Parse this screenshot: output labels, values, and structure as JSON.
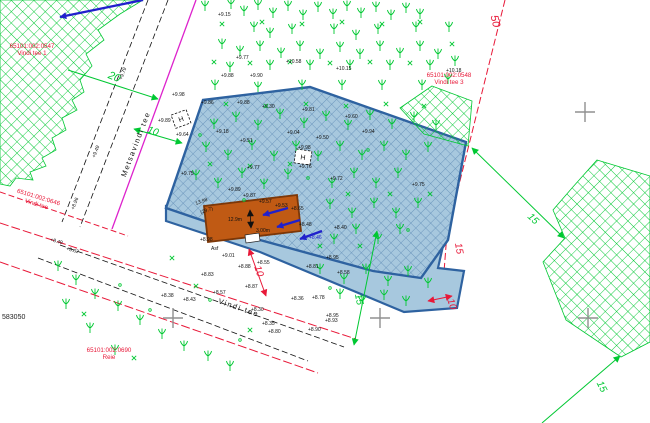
{
  "canvas": {
    "w": 650,
    "h": 423,
    "bg": "#ffffff"
  },
  "palette": {
    "cad_green": "#00c832",
    "cad_red": "#e81838",
    "magenta": "#dd22cc",
    "blue_arrow": "#2020cc",
    "parcel_fill": "#a7c8de",
    "parcel_hatch": "#5d89b4",
    "parcel_border": "#2e62a0",
    "building_fill": "#c05a14",
    "building_border": "#7c3708",
    "grid_gray": "#909090",
    "text_black": "#111111"
  },
  "areas": {
    "forest_nw": {
      "points": [
        [
          0,
          0
        ],
        [
          143,
          0
        ],
        [
          120,
          14
        ],
        [
          98,
          30
        ],
        [
          104,
          40
        ],
        [
          86,
          54
        ],
        [
          92,
          66
        ],
        [
          80,
          80
        ],
        [
          84,
          92
        ],
        [
          72,
          100
        ],
        [
          77,
          110
        ],
        [
          62,
          118
        ],
        [
          66,
          130
        ],
        [
          52,
          138
        ],
        [
          56,
          150
        ],
        [
          42,
          158
        ],
        [
          46,
          166
        ],
        [
          30,
          172
        ],
        [
          33,
          180
        ],
        [
          16,
          178
        ],
        [
          10,
          186
        ],
        [
          0,
          184
        ]
      ]
    },
    "forest_ne": {
      "points": [
        [
          432,
          86
        ],
        [
          472,
          101
        ],
        [
          468,
          146
        ],
        [
          424,
          134
        ],
        [
          400,
          108
        ]
      ]
    },
    "forest_se": {
      "points": [
        [
          597,
          160
        ],
        [
          650,
          176
        ],
        [
          650,
          342
        ],
        [
          621,
          357
        ],
        [
          566,
          320
        ],
        [
          543,
          262
        ],
        [
          565,
          238
        ],
        [
          553,
          210
        ],
        [
          572,
          188
        ]
      ]
    },
    "parcel_strip": {
      "points": [
        [
          166,
          206
        ],
        [
          445,
          237
        ],
        [
          438,
          268
        ],
        [
          464,
          271
        ],
        [
          457,
          308
        ],
        [
          404,
          312
        ],
        [
          260,
          252
        ],
        [
          166,
          221
        ]
      ]
    },
    "parcel_main": {
      "points": [
        [
          203,
          100
        ],
        [
          310,
          87
        ],
        [
          466,
          142
        ],
        [
          448,
          240
        ],
        [
          421,
          278
        ],
        [
          373,
          271
        ],
        [
          260,
          240
        ],
        [
          166,
          208
        ]
      ]
    }
  },
  "building": {
    "outline": [
      [
        204,
        206
      ],
      [
        297,
        195
      ],
      [
        301,
        231
      ],
      [
        208,
        242
      ]
    ],
    "annex": [
      [
        245,
        235
      ],
      [
        259,
        233
      ],
      [
        260,
        241
      ],
      [
        246,
        243
      ]
    ],
    "door_line": [
      250,
      210,
      251,
      228
    ],
    "labels": [
      {
        "t": "12.9m",
        "x": 228,
        "y": 221
      },
      {
        "t": "3.00m",
        "x": 256,
        "y": 232
      }
    ]
  },
  "road_lines": [
    {
      "x1": 196,
      "y1": 0,
      "x2": 112,
      "y2": 229,
      "c": "magenta",
      "w": 1.3,
      "d": ""
    },
    {
      "x1": 168,
      "y1": 0,
      "x2": 80,
      "y2": 227,
      "c": "black",
      "w": 0.8,
      "d": "6,3"
    },
    {
      "x1": 148,
      "y1": 0,
      "x2": 62,
      "y2": 222,
      "c": "black",
      "w": 0.8,
      "d": "6,3"
    },
    {
      "x1": 0,
      "y1": 223,
      "x2": 356,
      "y2": 339,
      "c": "red",
      "w": 1,
      "d": "9,3"
    },
    {
      "x1": 60,
      "y1": 245,
      "x2": 344,
      "y2": 347,
      "c": "black",
      "w": 0.8,
      "d": "6,3"
    },
    {
      "x1": 38,
      "y1": 258,
      "x2": 308,
      "y2": 361,
      "c": "black",
      "w": 0.8,
      "d": "6,3"
    },
    {
      "x1": 0,
      "y1": 262,
      "x2": 318,
      "y2": 373,
      "c": "red",
      "w": 1,
      "d": "9,3"
    },
    {
      "x1": 0,
      "y1": 192,
      "x2": 128,
      "y2": 236,
      "c": "red",
      "w": 1,
      "d": "6,3"
    },
    {
      "x1": 505,
      "y1": 0,
      "x2": 447,
      "y2": 233,
      "c": "red",
      "w": 1,
      "d": "7,3"
    },
    {
      "x1": 447,
      "y1": 233,
      "x2": 442,
      "y2": 298,
      "c": "red",
      "w": 1,
      "d": "7,3"
    }
  ],
  "road_names": [
    {
      "t": "Metsavindi tee",
      "x": 138,
      "y": 145,
      "r": -69
    },
    {
      "t": "Vindi tee",
      "x": 238,
      "y": 310,
      "r": 19
    }
  ],
  "dimensions": [
    {
      "t": "20",
      "x": 113,
      "y": 80,
      "r": 22,
      "c": "green",
      "s": 11,
      "line": [
        68,
        70,
        158,
        99
      ],
      "heads": "end"
    },
    {
      "t": "10",
      "x": 152,
      "y": 134,
      "r": 20,
      "c": "green",
      "s": 10,
      "line": [
        134,
        129,
        182,
        143
      ],
      "heads": "both"
    },
    {
      "t": "50",
      "x": 492,
      "y": 22,
      "r": 76,
      "c": "red",
      "s": 11
    },
    {
      "t": "15",
      "x": 456,
      "y": 249,
      "r": 80,
      "c": "red",
      "s": 10
    },
    {
      "t": "10",
      "x": 449,
      "y": 305,
      "r": 72,
      "c": "red",
      "s": 10,
      "line": [
        428,
        301,
        452,
        296
      ],
      "heads": "both"
    },
    {
      "t": "10",
      "x": 256,
      "y": 272,
      "r": 72,
      "c": "red",
      "s": 10,
      "line": [
        249,
        249,
        266,
        296
      ],
      "heads": "both"
    },
    {
      "t": "15",
      "x": 356,
      "y": 300,
      "r": 78,
      "c": "green",
      "s": 10,
      "line": [
        377,
        231,
        354,
        345
      ],
      "heads": "both"
    },
    {
      "t": "15",
      "x": 531,
      "y": 221,
      "r": 44,
      "c": "green",
      "s": 10,
      "line": [
        472,
        148,
        564,
        238
      ],
      "heads": "both"
    },
    {
      "t": "15",
      "x": 599,
      "y": 388,
      "r": 63,
      "c": "green",
      "s": 10,
      "line": [
        620,
        356,
        542,
        423
      ],
      "heads": "start"
    }
  ],
  "cadastral": [
    {
      "lines": [
        "65101:002:0547",
        "Vindi tee 1"
      ],
      "x": 32,
      "y": 48,
      "r": 0
    },
    {
      "lines": [
        "65101:002:0548",
        "Vindi tee 3"
      ],
      "x": 449,
      "y": 77,
      "r": 0
    },
    {
      "lines": [
        "65101:002:0690",
        "Reie"
      ],
      "x": 109,
      "y": 352,
      "r": 0
    },
    {
      "lines": [
        "65101:002:0646",
        "Vindi tee"
      ],
      "x": 38,
      "y": 199,
      "r": 17
    }
  ],
  "grid": {
    "coord_label": {
      "t": "583050",
      "x": 2,
      "y": 319
    },
    "crosses": [
      [
        173,
        318
      ],
      [
        380,
        318
      ],
      [
        588,
        318
      ],
      [
        585,
        112
      ]
    ]
  },
  "elevations": [
    {
      "t": "+9.15",
      "x": 218,
      "y": 16
    },
    {
      "t": "+9.77",
      "x": 236,
      "y": 59
    },
    {
      "t": "+10.58",
      "x": 286,
      "y": 63
    },
    {
      "t": "+9.88",
      "x": 221,
      "y": 77
    },
    {
      "t": "+9.90",
      "x": 250,
      "y": 77
    },
    {
      "t": "+10.15",
      "x": 336,
      "y": 70
    },
    {
      "t": "+10.18",
      "x": 446,
      "y": 72
    },
    {
      "t": "+9.98",
      "x": 172,
      "y": 96
    },
    {
      "t": "+9.89",
      "x": 158,
      "y": 122
    },
    {
      "t": "+9.86",
      "x": 201,
      "y": 104
    },
    {
      "t": "+9.88",
      "x": 237,
      "y": 104
    },
    {
      "t": "+9.30",
      "x": 262,
      "y": 108
    },
    {
      "t": "+9.81",
      "x": 302,
      "y": 111
    },
    {
      "t": "+9.64",
      "x": 176,
      "y": 136
    },
    {
      "t": "+9.18",
      "x": 216,
      "y": 133
    },
    {
      "t": "+9.04",
      "x": 287,
      "y": 134
    },
    {
      "t": "+9.50",
      "x": 316,
      "y": 139
    },
    {
      "t": "+9.51",
      "x": 240,
      "y": 142
    },
    {
      "t": "+9.98",
      "x": 298,
      "y": 149
    },
    {
      "t": "+9.60",
      "x": 345,
      "y": 118
    },
    {
      "t": "+9.94",
      "x": 362,
      "y": 133
    },
    {
      "t": "+9.77",
      "x": 247,
      "y": 169
    },
    {
      "t": "+9.76",
      "x": 299,
      "y": 168
    },
    {
      "t": "+9.75",
      "x": 181,
      "y": 175
    },
    {
      "t": "+9.72",
      "x": 330,
      "y": 180
    },
    {
      "t": "+9.75",
      "x": 412,
      "y": 186
    },
    {
      "t": "+9.89",
      "x": 228,
      "y": 191
    },
    {
      "t": "+9.87",
      "x": 243,
      "y": 197
    },
    {
      "t": "+9.57",
      "x": 259,
      "y": 203
    },
    {
      "t": "+9.53",
      "x": 275,
      "y": 207
    },
    {
      "t": "+8.65",
      "x": 291,
      "y": 210
    },
    {
      "t": "+8.48",
      "x": 299,
      "y": 226
    },
    {
      "t": "13.98",
      "x": 196,
      "y": 205,
      "r": -20
    },
    {
      "t": "(29.7)",
      "x": 201,
      "y": 214,
      "r": -20
    },
    {
      "t": "+8.55",
      "x": 257,
      "y": 264
    },
    {
      "t": "+8.40",
      "x": 334,
      "y": 229
    },
    {
      "t": "+8.46",
      "x": 309,
      "y": 239,
      "c": "#2020cc"
    },
    {
      "t": "+8.95",
      "x": 326,
      "y": 259
    },
    {
      "t": "+8.81",
      "x": 306,
      "y": 268
    },
    {
      "t": "+8.58",
      "x": 337,
      "y": 274
    },
    {
      "t": "+8.78",
      "x": 312,
      "y": 299
    },
    {
      "t": "+8.95",
      "x": 326,
      "y": 317
    },
    {
      "t": "Asf",
      "x": 211,
      "y": 250
    },
    {
      "t": "+9.01",
      "x": 222,
      "y": 257
    },
    {
      "t": "+8.98",
      "x": 200,
      "y": 241
    },
    {
      "t": "+8.88",
      "x": 238,
      "y": 268
    },
    {
      "t": "+8.83",
      "x": 201,
      "y": 276
    },
    {
      "t": "+8.87",
      "x": 245,
      "y": 288
    },
    {
      "t": "+8.57",
      "x": 213,
      "y": 294
    },
    {
      "t": "+8.43",
      "x": 183,
      "y": 301
    },
    {
      "t": "+8.38",
      "x": 161,
      "y": 297
    },
    {
      "t": "+8.36",
      "x": 291,
      "y": 300
    },
    {
      "t": "+8.30",
      "x": 251,
      "y": 311
    },
    {
      "t": "+8.93",
      "x": 325,
      "y": 322
    },
    {
      "t": "+8.90",
      "x": 308,
      "y": 331
    },
    {
      "t": "+8.80",
      "x": 268,
      "y": 333
    },
    {
      "t": "+8.35",
      "x": 262,
      "y": 325
    },
    {
      "t": "+8.49",
      "x": 50,
      "y": 241,
      "r": 15
    },
    {
      "t": "+8.62",
      "x": 66,
      "y": 250,
      "r": 15
    },
    {
      "t": "+9.79",
      "x": 122,
      "y": 80,
      "r": -69
    },
    {
      "t": "+9.49",
      "x": 95,
      "y": 158,
      "r": -69
    },
    {
      "t": "+8.96",
      "x": 74,
      "y": 210,
      "r": -69
    }
  ],
  "hboxes": [
    {
      "x": 181,
      "y": 119,
      "r": -20
    },
    {
      "x": 303,
      "y": 157,
      "r": 8
    }
  ],
  "h_label": "H",
  "blue_arrows": [
    [
      143,
      0,
      60,
      17
    ],
    [
      288,
      208,
      263,
      215
    ],
    [
      300,
      220,
      277,
      227
    ],
    [
      322,
      231,
      300,
      239
    ]
  ],
  "trees": [
    [
      205,
      8
    ],
    [
      231,
      6
    ],
    [
      258,
      7
    ],
    [
      288,
      8
    ],
    [
      318,
      9
    ],
    [
      347,
      8
    ],
    [
      376,
      9
    ],
    [
      406,
      10
    ],
    [
      244,
      13
    ],
    [
      273,
      15
    ],
    [
      303,
      17
    ],
    [
      333,
      16
    ],
    [
      361,
      15
    ],
    [
      391,
      17
    ],
    [
      420,
      16
    ],
    [
      254,
      29
    ],
    [
      292,
      31
    ],
    [
      334,
      31
    ],
    [
      378,
      31
    ],
    [
      416,
      29
    ],
    [
      449,
      29
    ],
    [
      270,
      35
    ],
    [
      356,
      37
    ],
    [
      222,
      46
    ],
    [
      260,
      48
    ],
    [
      300,
      48
    ],
    [
      340,
      49
    ],
    [
      380,
      48
    ],
    [
      420,
      48
    ],
    [
      240,
      53
    ],
    [
      281,
      55
    ],
    [
      320,
      56
    ],
    [
      360,
      56
    ],
    [
      400,
      55
    ],
    [
      438,
      56
    ],
    [
      455,
      63
    ],
    [
      230,
      69
    ],
    [
      270,
      67
    ],
    [
      310,
      67
    ],
    [
      350,
      67
    ],
    [
      390,
      67
    ],
    [
      430,
      67
    ],
    [
      448,
      81
    ],
    [
      215,
      87
    ],
    [
      258,
      89
    ],
    [
      302,
      87
    ],
    [
      342,
      87
    ],
    [
      382,
      87
    ],
    [
      422,
      87
    ],
    [
      214,
      126
    ],
    [
      236,
      119
    ],
    [
      258,
      127
    ],
    [
      280,
      116
    ],
    [
      304,
      125
    ],
    [
      326,
      118
    ],
    [
      348,
      127
    ],
    [
      370,
      117
    ],
    [
      392,
      126
    ],
    [
      414,
      119
    ],
    [
      436,
      127
    ],
    [
      206,
      149
    ],
    [
      228,
      157
    ],
    [
      252,
      147
    ],
    [
      274,
      158
    ],
    [
      296,
      148
    ],
    [
      318,
      158
    ],
    [
      340,
      148
    ],
    [
      362,
      157
    ],
    [
      384,
      148
    ],
    [
      406,
      157
    ],
    [
      428,
      149
    ],
    [
      196,
      177
    ],
    [
      218,
      185
    ],
    [
      242,
      175
    ],
    [
      264,
      186
    ],
    [
      288,
      176
    ],
    [
      332,
      185
    ],
    [
      354,
      175
    ],
    [
      376,
      185
    ],
    [
      398,
      175
    ],
    [
      330,
      206
    ],
    [
      352,
      215
    ],
    [
      374,
      205
    ],
    [
      396,
      215
    ],
    [
      418,
      205
    ],
    [
      334,
      241
    ],
    [
      356,
      231
    ],
    [
      378,
      241
    ],
    [
      400,
      231
    ],
    [
      320,
      271
    ],
    [
      344,
      281
    ],
    [
      366,
      271
    ],
    [
      388,
      283
    ],
    [
      408,
      273
    ],
    [
      428,
      285
    ],
    [
      340,
      296
    ],
    [
      362,
      303
    ],
    [
      384,
      297
    ],
    [
      406,
      303
    ],
    [
      58,
      268
    ],
    [
      76,
      282
    ],
    [
      95,
      296
    ],
    [
      118,
      308
    ],
    [
      140,
      322
    ],
    [
      162,
      336
    ],
    [
      184,
      348
    ],
    [
      208,
      358
    ],
    [
      230,
      368
    ],
    [
      66,
      306
    ],
    [
      90,
      330
    ],
    [
      115,
      352
    ]
  ],
  "xmarks": [
    [
      222,
      24
    ],
    [
      262,
      22
    ],
    [
      302,
      24
    ],
    [
      342,
      22
    ],
    [
      382,
      24
    ],
    [
      420,
      22
    ],
    [
      452,
      44
    ],
    [
      214,
      62
    ],
    [
      250,
      63
    ],
    [
      290,
      62
    ],
    [
      330,
      63
    ],
    [
      370,
      62
    ],
    [
      410,
      63
    ],
    [
      226,
      104
    ],
    [
      266,
      106
    ],
    [
      306,
      104
    ],
    [
      346,
      106
    ],
    [
      386,
      104
    ],
    [
      424,
      106
    ],
    [
      210,
      164
    ],
    [
      250,
      166
    ],
    [
      290,
      164
    ],
    [
      348,
      194
    ],
    [
      390,
      194
    ],
    [
      430,
      194
    ],
    [
      320,
      246
    ],
    [
      360,
      246
    ],
    [
      172,
      258
    ],
    [
      196,
      286
    ],
    [
      250,
      330
    ],
    [
      84,
      314
    ],
    [
      134,
      358
    ]
  ],
  "dots": [
    [
      200,
      135
    ],
    [
      244,
      200
    ],
    [
      308,
      178
    ],
    [
      368,
      150
    ],
    [
      408,
      230
    ],
    [
      330,
      288
    ],
    [
      210,
      300
    ],
    [
      120,
      285
    ],
    [
      150,
      310
    ],
    [
      240,
      340
    ]
  ]
}
